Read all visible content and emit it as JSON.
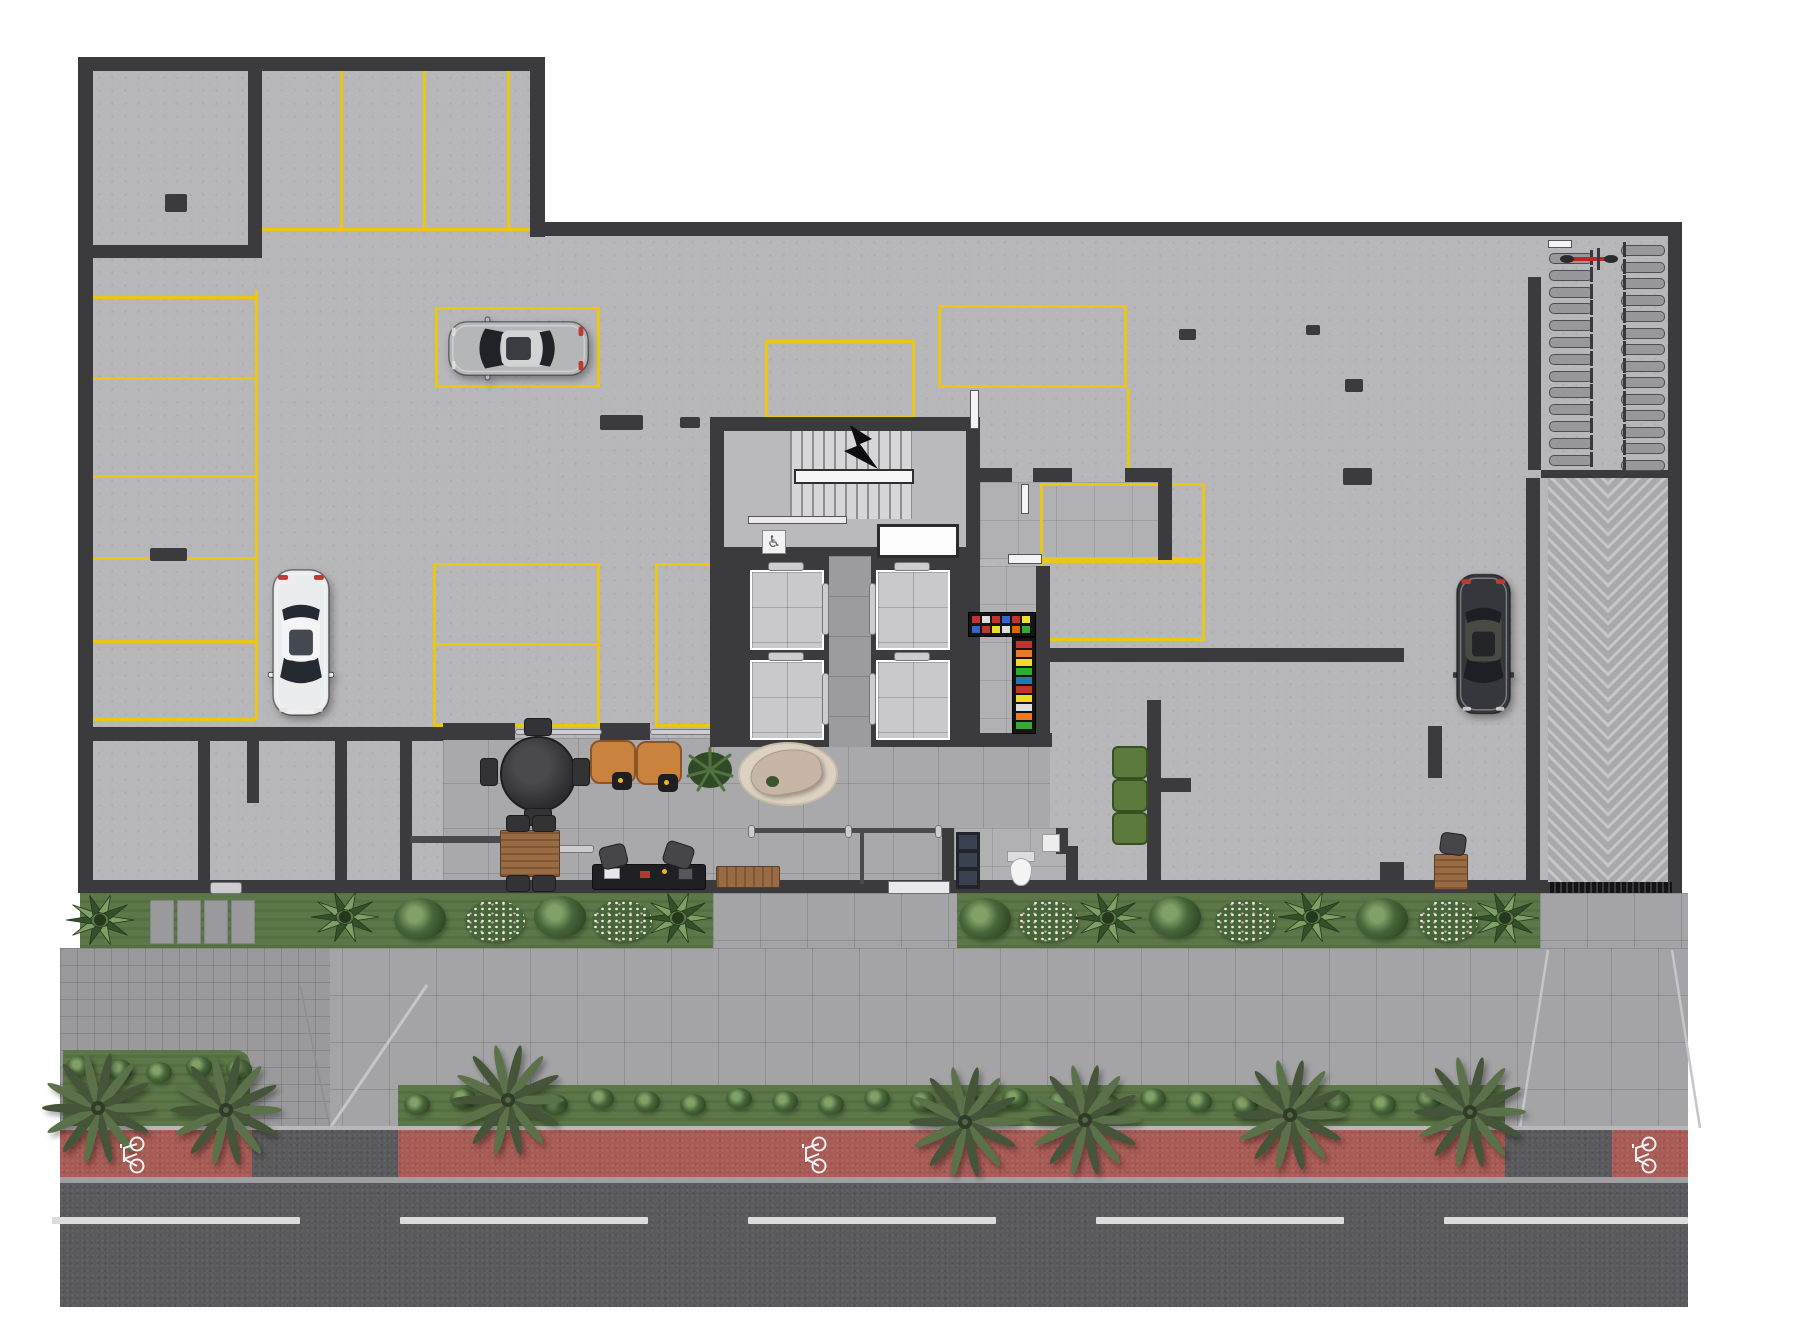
{
  "scene": {
    "type": "architectural floor plan",
    "view": "top-down color render",
    "level": "ground floor with parking garage, lobby, elevator core, bike room, ramp and street"
  },
  "icons": {
    "wheelchair": "♿"
  },
  "colors": {
    "wall": "#3b3a3d",
    "concrete": "#b7b6b8",
    "tile_lobby": "#a9a8ab",
    "tile_room": "#b1b0b3",
    "tile_cab": "#c9c8ca",
    "tile_corridor": "#9c9b9e",
    "stall_yellow": "#e9c714",
    "sidewalk": "#a4a3a5",
    "sidewalk_small": "#9a999b",
    "paver_line": "rgba(0,0,0,0.13)",
    "grass": "#5d7848",
    "foliage_dark": "#2c421f",
    "foliage_mid": "#47663a",
    "foliage_light": "#81a167",
    "flower_white": "#efece2",
    "red_lane": "#a85a54",
    "asphalt": "#5a5a5c",
    "lane_white": "#dcdcdc",
    "curb": "#b8b7b9",
    "gutter": "#9f9fa1",
    "ramp_base": "#a9a8aa",
    "ramp_stripe": "#c6c5c7",
    "wood": "#9a6b42",
    "chair_tan": "#c9833f",
    "chair_green": "#5c7a3e",
    "rug": "#ddd2c2",
    "sofa": "#c7b5a6",
    "elevator_silver": "#cdcdd0",
    "vending_base": "#141414",
    "handrail": "#f6f6f7"
  },
  "cars": {
    "silver-suv": {
      "body": "#b4b6b8",
      "roof": "#d2d3d5",
      "glass": "#1f2227",
      "x": 447,
      "y": 315,
      "w": 143,
      "h": 67,
      "rot": -90
    },
    "white-sedan": {
      "body": "#ebecee",
      "roof": "#f5f5f7",
      "glass": "#252932",
      "x": 268,
      "y": 568,
      "w": 66,
      "h": 149,
      "rot": 180
    },
    "dark-suv": {
      "body": "#35373c",
      "roof": "#4a4a44",
      "glass": "#1d1f24",
      "x": 1453,
      "y": 572,
      "w": 61,
      "h": 144,
      "rot": 180
    }
  },
  "counts": {
    "elevators": 4,
    "cars": 3,
    "palm_trees": 7,
    "bike_lane_symbols": 3,
    "bike_racks_left": 13,
    "bike_racks_right": 14,
    "green_armchairs": 3,
    "lounge_chairs": 2
  },
  "plan": {
    "walls": [
      [
        78,
        57,
        467,
        14
      ],
      [
        78,
        57,
        15,
        836
      ],
      [
        530,
        57,
        15,
        180
      ],
      [
        530,
        222,
        1152,
        14
      ],
      [
        1668,
        222,
        14,
        671
      ],
      [
        78,
        880,
        1604,
        13
      ],
      [
        248,
        57,
        14,
        201
      ],
      [
        78,
        245,
        184,
        13
      ],
      [
        93,
        727,
        350,
        14
      ],
      [
        198,
        741,
        12,
        140
      ],
      [
        335,
        741,
        12,
        140
      ],
      [
        400,
        741,
        12,
        140
      ],
      [
        247,
        741,
        12,
        62
      ],
      [
        443,
        723,
        72,
        17
      ],
      [
        600,
        723,
        50,
        17
      ],
      [
        740,
        723,
        42,
        17
      ],
      [
        845,
        723,
        40,
        17
      ],
      [
        953,
        733,
        99,
        14
      ],
      [
        1036,
        566,
        14,
        181
      ],
      [
        1048,
        648,
        356,
        14
      ],
      [
        1147,
        700,
        14,
        180
      ],
      [
        1161,
        778,
        30,
        14
      ],
      [
        1380,
        862,
        24,
        31
      ],
      [
        1428,
        726,
        14,
        52
      ],
      [
        1526,
        478,
        14,
        415
      ],
      [
        1528,
        277,
        13,
        193
      ],
      [
        1541,
        470,
        131,
        8
      ],
      [
        955,
        468,
        57,
        14
      ],
      [
        1033,
        468,
        39,
        14
      ],
      [
        1125,
        468,
        47,
        14
      ],
      [
        1158,
        468,
        14,
        92
      ],
      [
        942,
        828,
        12,
        65
      ],
      [
        1056,
        828,
        12,
        26
      ],
      [
        1066,
        846,
        12,
        47
      ]
    ],
    "columns": [
      [
        165,
        194,
        22,
        18
      ],
      [
        150,
        548,
        37,
        13
      ],
      [
        600,
        415,
        43,
        15
      ],
      [
        680,
        417,
        20,
        11
      ],
      [
        1179,
        329,
        17,
        11
      ],
      [
        1345,
        379,
        18,
        13
      ],
      [
        1343,
        468,
        29,
        17
      ],
      [
        1528,
        548,
        12,
        27
      ],
      [
        1528,
        700,
        12,
        25
      ],
      [
        1306,
        325,
        14,
        10
      ]
    ],
    "stall_vlines": [
      [
        340,
        71,
        160
      ],
      [
        423,
        71,
        160
      ],
      [
        507,
        71,
        160
      ],
      [
        255,
        290,
        430
      ],
      [
        1127,
        388,
        80
      ]
    ],
    "stall_hlines": [
      [
        262,
        228,
        268
      ],
      [
        93,
        296,
        163
      ],
      [
        93,
        377,
        163
      ],
      [
        93,
        475,
        163
      ],
      [
        93,
        557,
        163
      ],
      [
        93,
        640,
        163
      ],
      [
        93,
        718,
        163
      ],
      [
        938,
        385,
        189
      ],
      [
        433,
        643,
        167
      ]
    ],
    "stall_boxes": [
      [
        435,
        307,
        165,
        81
      ],
      [
        765,
        340,
        150,
        79
      ],
      [
        938,
        305,
        189,
        83
      ],
      [
        1040,
        483,
        165,
        77
      ],
      [
        1040,
        560,
        165,
        81
      ],
      [
        433,
        563,
        167,
        164
      ],
      [
        655,
        563,
        80,
        164,
        "open-right"
      ]
    ],
    "street_dashes": [
      [
        52,
        248
      ],
      [
        400,
        248
      ],
      [
        748,
        248
      ],
      [
        1096,
        248
      ],
      [
        1444,
        244
      ]
    ],
    "bike_symbols_x": [
      130,
      812,
      1642
    ],
    "palms": [
      [
        98,
        1108
      ],
      [
        226,
        1110
      ],
      [
        508,
        1100
      ],
      [
        965,
        1122
      ],
      [
        1085,
        1120
      ],
      [
        1290,
        1115
      ],
      [
        1470,
        1112
      ]
    ],
    "street_bushes": {
      "from": 404,
      "to": 1495,
      "step": 46,
      "y": 1088
    },
    "left_bed_bushes": {
      "from": 66,
      "to": 240,
      "step": 40,
      "y": 1056
    },
    "bed_plants": [
      [
        "agave",
        100,
        920
      ],
      [
        "step-group",
        150,
        900
      ],
      [
        "agave",
        345,
        917
      ],
      [
        "fern",
        420,
        918
      ],
      [
        "flowers",
        495,
        920
      ],
      [
        "fern",
        560,
        916
      ],
      [
        "flowers",
        622,
        920
      ],
      [
        "agave",
        678,
        918
      ],
      [
        "fern",
        985,
        918
      ],
      [
        "flowers",
        1048,
        920
      ],
      [
        "agave",
        1108,
        918
      ],
      [
        "fern",
        1175,
        916
      ],
      [
        "flowers",
        1245,
        920
      ],
      [
        "agave",
        1312,
        917
      ],
      [
        "fern",
        1382,
        918
      ],
      [
        "flowers",
        1448,
        920
      ],
      [
        "agave",
        1505,
        918
      ]
    ],
    "bike_racks": {
      "left": {
        "x": 1549,
        "y0": 253,
        "dy": 16.8,
        "n": 13,
        "dir": "r"
      },
      "right": {
        "x": 1621,
        "y0": 245,
        "dy": 16.5,
        "n": 14,
        "dir": "l"
      }
    },
    "vending": {
      "h": {
        "x": 968,
        "y": 612,
        "w": 66,
        "h": 23,
        "row1": [
          "#c23330",
          "#dddddd",
          "#c23330",
          "#3366cc",
          "#c23330",
          "#eedd33"
        ],
        "row2": [
          "#3366cc",
          "#c23330",
          "#eedd33",
          "#dddddd",
          "#dd6600",
          "#33aa33"
        ]
      },
      "v": {
        "x": 1012,
        "y": 637,
        "w": 22,
        "h": 95,
        "chips": [
          "#c23330",
          "#ee7722",
          "#eedd22",
          "#33aa33",
          "#2277bb",
          "#c23330",
          "#eedd22",
          "#dddddd",
          "#ee7722",
          "#33aa33"
        ]
      }
    }
  }
}
